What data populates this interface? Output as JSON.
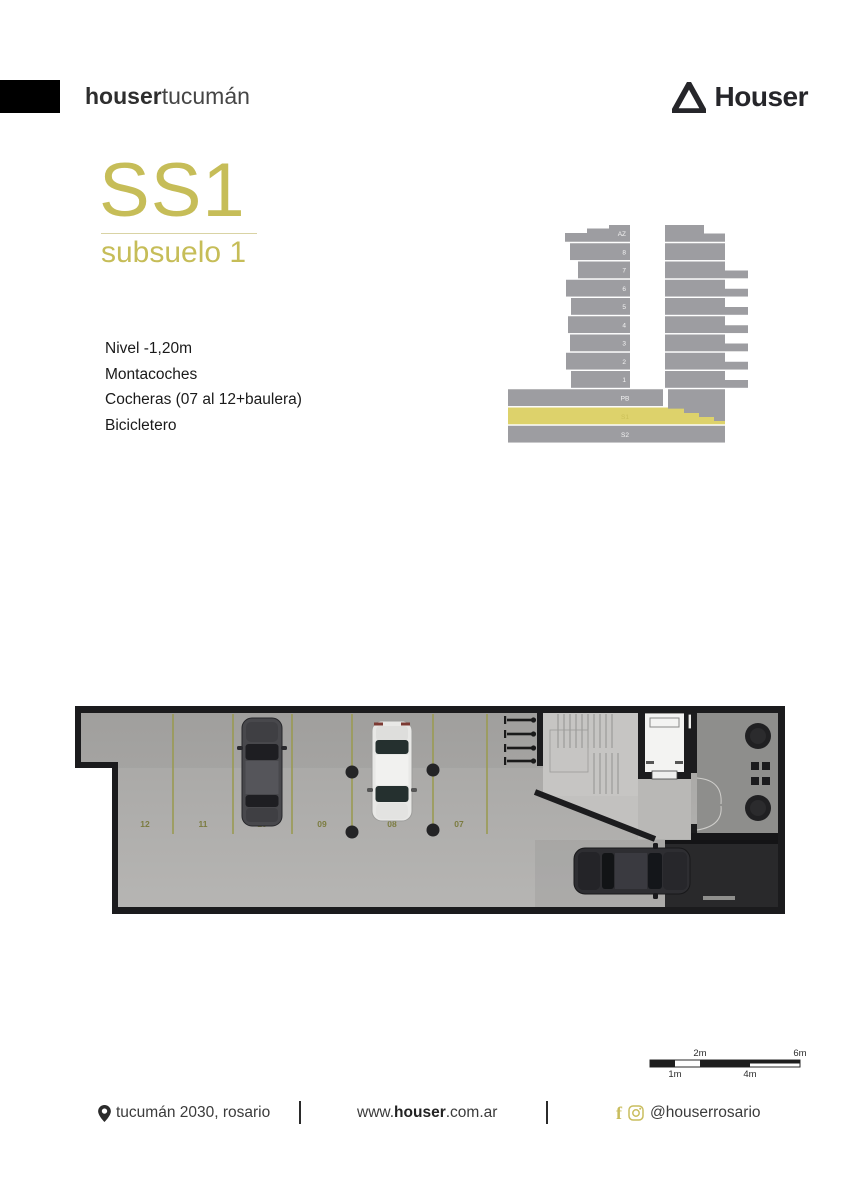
{
  "header": {
    "brand_bold": "houser",
    "brand_light": "tucumán",
    "logo_text": "Houser"
  },
  "title": {
    "code": "SS1",
    "subtitle": "subsuelo 1"
  },
  "details": [
    "Nivel -1,20m",
    "Montacoches",
    "Cocheras (07 al 12+baulera)",
    "Bicicletero"
  ],
  "elevation": {
    "floors": [
      "AZ",
      "8",
      "7",
      "6",
      "5",
      "4",
      "3",
      "2",
      "1",
      "PB",
      "S1",
      "S2"
    ],
    "highlighted_floor": "S1",
    "bar_color": "#9d9da1",
    "highlight_color": "#ddd26b"
  },
  "floor_plan": {
    "parking_spots": [
      "12",
      "11",
      "10",
      "09",
      "08",
      "07"
    ],
    "line_color": "#9a9a52",
    "spot_label_color": "#7c7c40"
  },
  "scale_bar": {
    "labels": [
      "1m",
      "2m",
      "4m",
      "6m"
    ]
  },
  "footer": {
    "address": "tucumán 2030, rosario",
    "website_pre": "www.",
    "website_bold": "houser",
    "website_post": ".com.ar",
    "social": "@houserrosario"
  },
  "colors": {
    "accent": "#c6bd58",
    "dark": "#26262a"
  }
}
